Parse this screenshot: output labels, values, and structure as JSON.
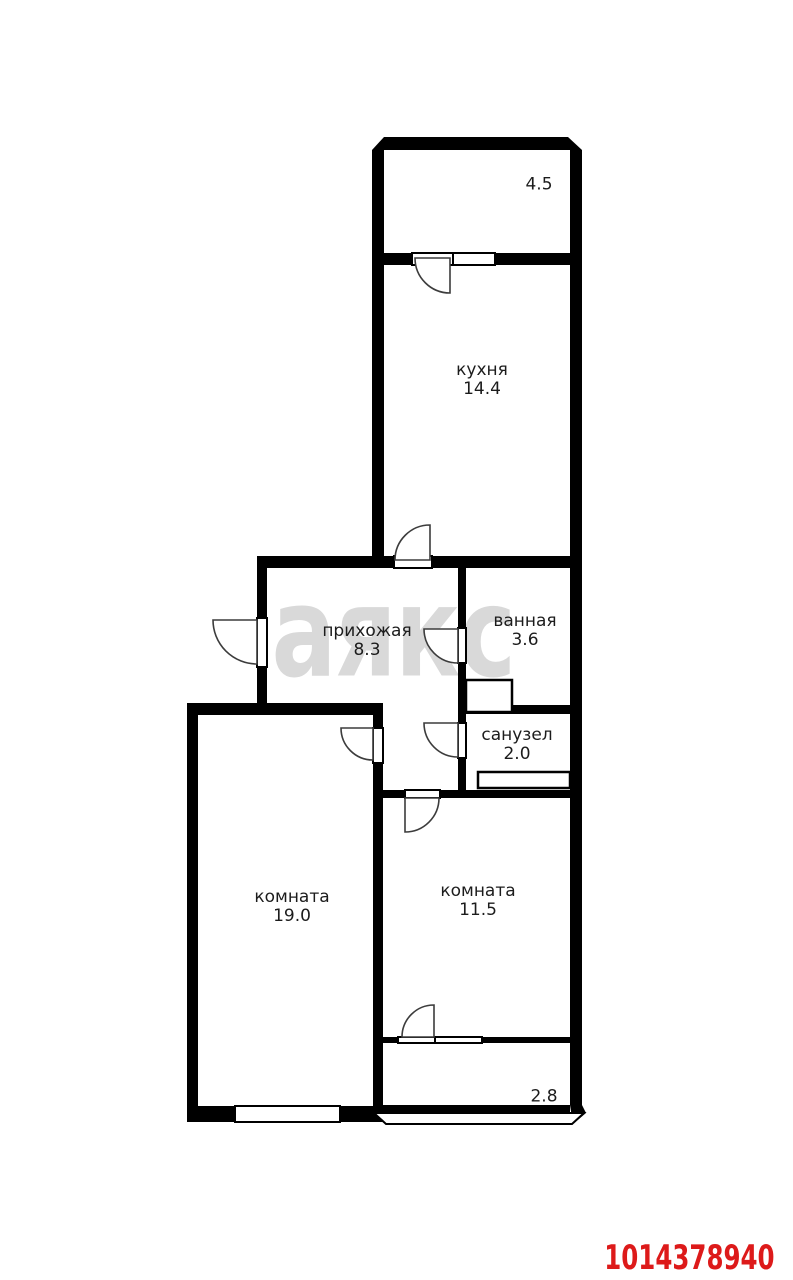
{
  "plan": {
    "watermark": "аякс",
    "listing_id": "1014378940",
    "rooms": {
      "balcony_top": {
        "name": "",
        "area": "4.5"
      },
      "kitchen": {
        "name": "кухня",
        "area": "14.4"
      },
      "hallway": {
        "name": "прихожая",
        "area": "8.3"
      },
      "bathroom": {
        "name": "ванная",
        "area": "3.6"
      },
      "wc": {
        "name": "санузел",
        "area": "2.0"
      },
      "room_large": {
        "name": "комната",
        "area": "19.0"
      },
      "room_small": {
        "name": "комната",
        "area": "11.5"
      },
      "balcony_bottom": {
        "name": "",
        "area": "2.8"
      }
    },
    "colors": {
      "wall": "#000000",
      "label": "#1c1c1c",
      "listing_id": "#dd1a1a",
      "watermark": "#d9d9d9",
      "background": "#ffffff"
    }
  }
}
